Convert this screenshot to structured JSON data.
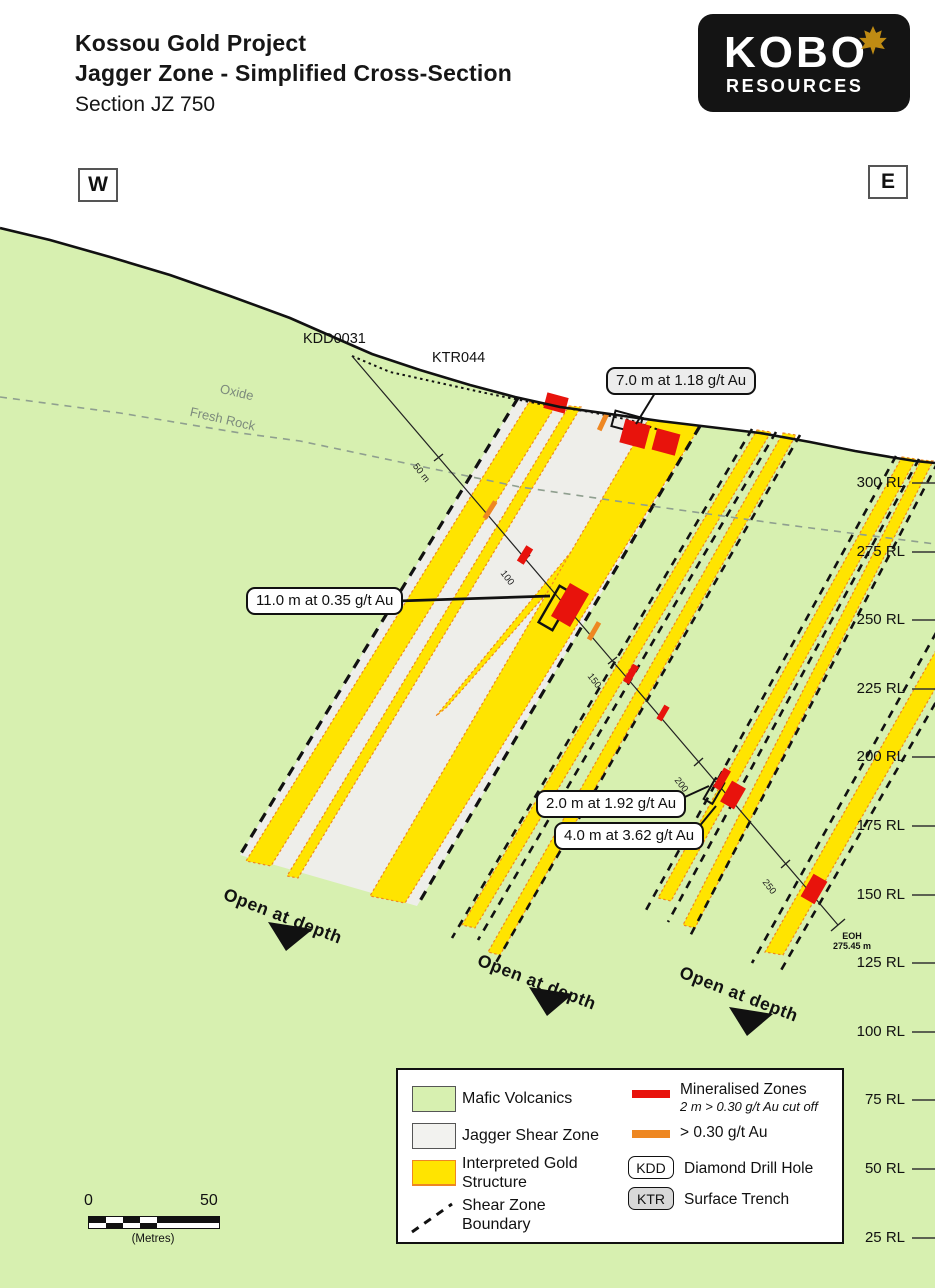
{
  "title": {
    "line1": "Kossou Gold Project",
    "line2": "Jagger Zone - Simplified Cross-Section",
    "line3": "Section JZ 750"
  },
  "logo": {
    "name": "KOBO",
    "subtitle": "RESOURCES"
  },
  "compass": {
    "west": "W",
    "east": "E"
  },
  "map": {
    "drillhole_label": "KDD0031",
    "trench_label": "KTR044",
    "weathering": {
      "upper": "Oxide",
      "lower": "Fresh Rock"
    },
    "depth_marks": [
      "50 m",
      "100",
      "150",
      "200",
      "250"
    ],
    "eoh": {
      "line1": "EOH",
      "line2": "275.45 m"
    },
    "callouts": {
      "c7": "7.0 m at 1.18 g/t Au",
      "c11": "11.0 m at 0.35 g/t Au",
      "c2": "2.0 m at 1.92 g/t Au",
      "c4": "4.0 m at 3.62 g/t Au"
    },
    "open_at_depth": "Open at depth",
    "rl_labels": [
      "300 RL",
      "275 RL",
      "250 RL",
      "225 RL",
      "200 RL",
      "175 RL",
      "150 RL",
      "125 RL",
      "100 RL",
      "75 RL",
      "50 RL",
      "25 RL"
    ]
  },
  "legend": {
    "items_left": [
      {
        "label": "Mafic Volcanics"
      },
      {
        "label": "Jagger Shear Zone"
      },
      {
        "label_line1": "Interpreted Gold",
        "label_line2": "Structure"
      },
      {
        "label_line1": "Shear Zone",
        "label_line2": "Boundary"
      }
    ],
    "items_right": [
      {
        "label": "Mineralised Zones",
        "sublabel": "2 m > 0.30 g/t Au cut off"
      },
      {
        "label": "> 0.30 g/t Au"
      },
      {
        "badge": "KDD",
        "label": "Diamond Drill Hole"
      },
      {
        "badge": "KTR",
        "label": "Surface Trench"
      }
    ]
  },
  "scalebar": {
    "start": "0",
    "end": "50",
    "unit": "(Metres)"
  },
  "colors": {
    "mafic_green": "#d7f0b0",
    "shear_gray": "#eeeeea",
    "gold_yellow": "#ffe400",
    "orange": "#ee8722",
    "red": "#e8130c",
    "line_black": "#111111",
    "oxide_gray": "#8f9f8f",
    "logo_bg": "#141414",
    "logo_leaf_gold": "#bf8b13",
    "ktr_badge_gray": "#d8d8d8"
  }
}
